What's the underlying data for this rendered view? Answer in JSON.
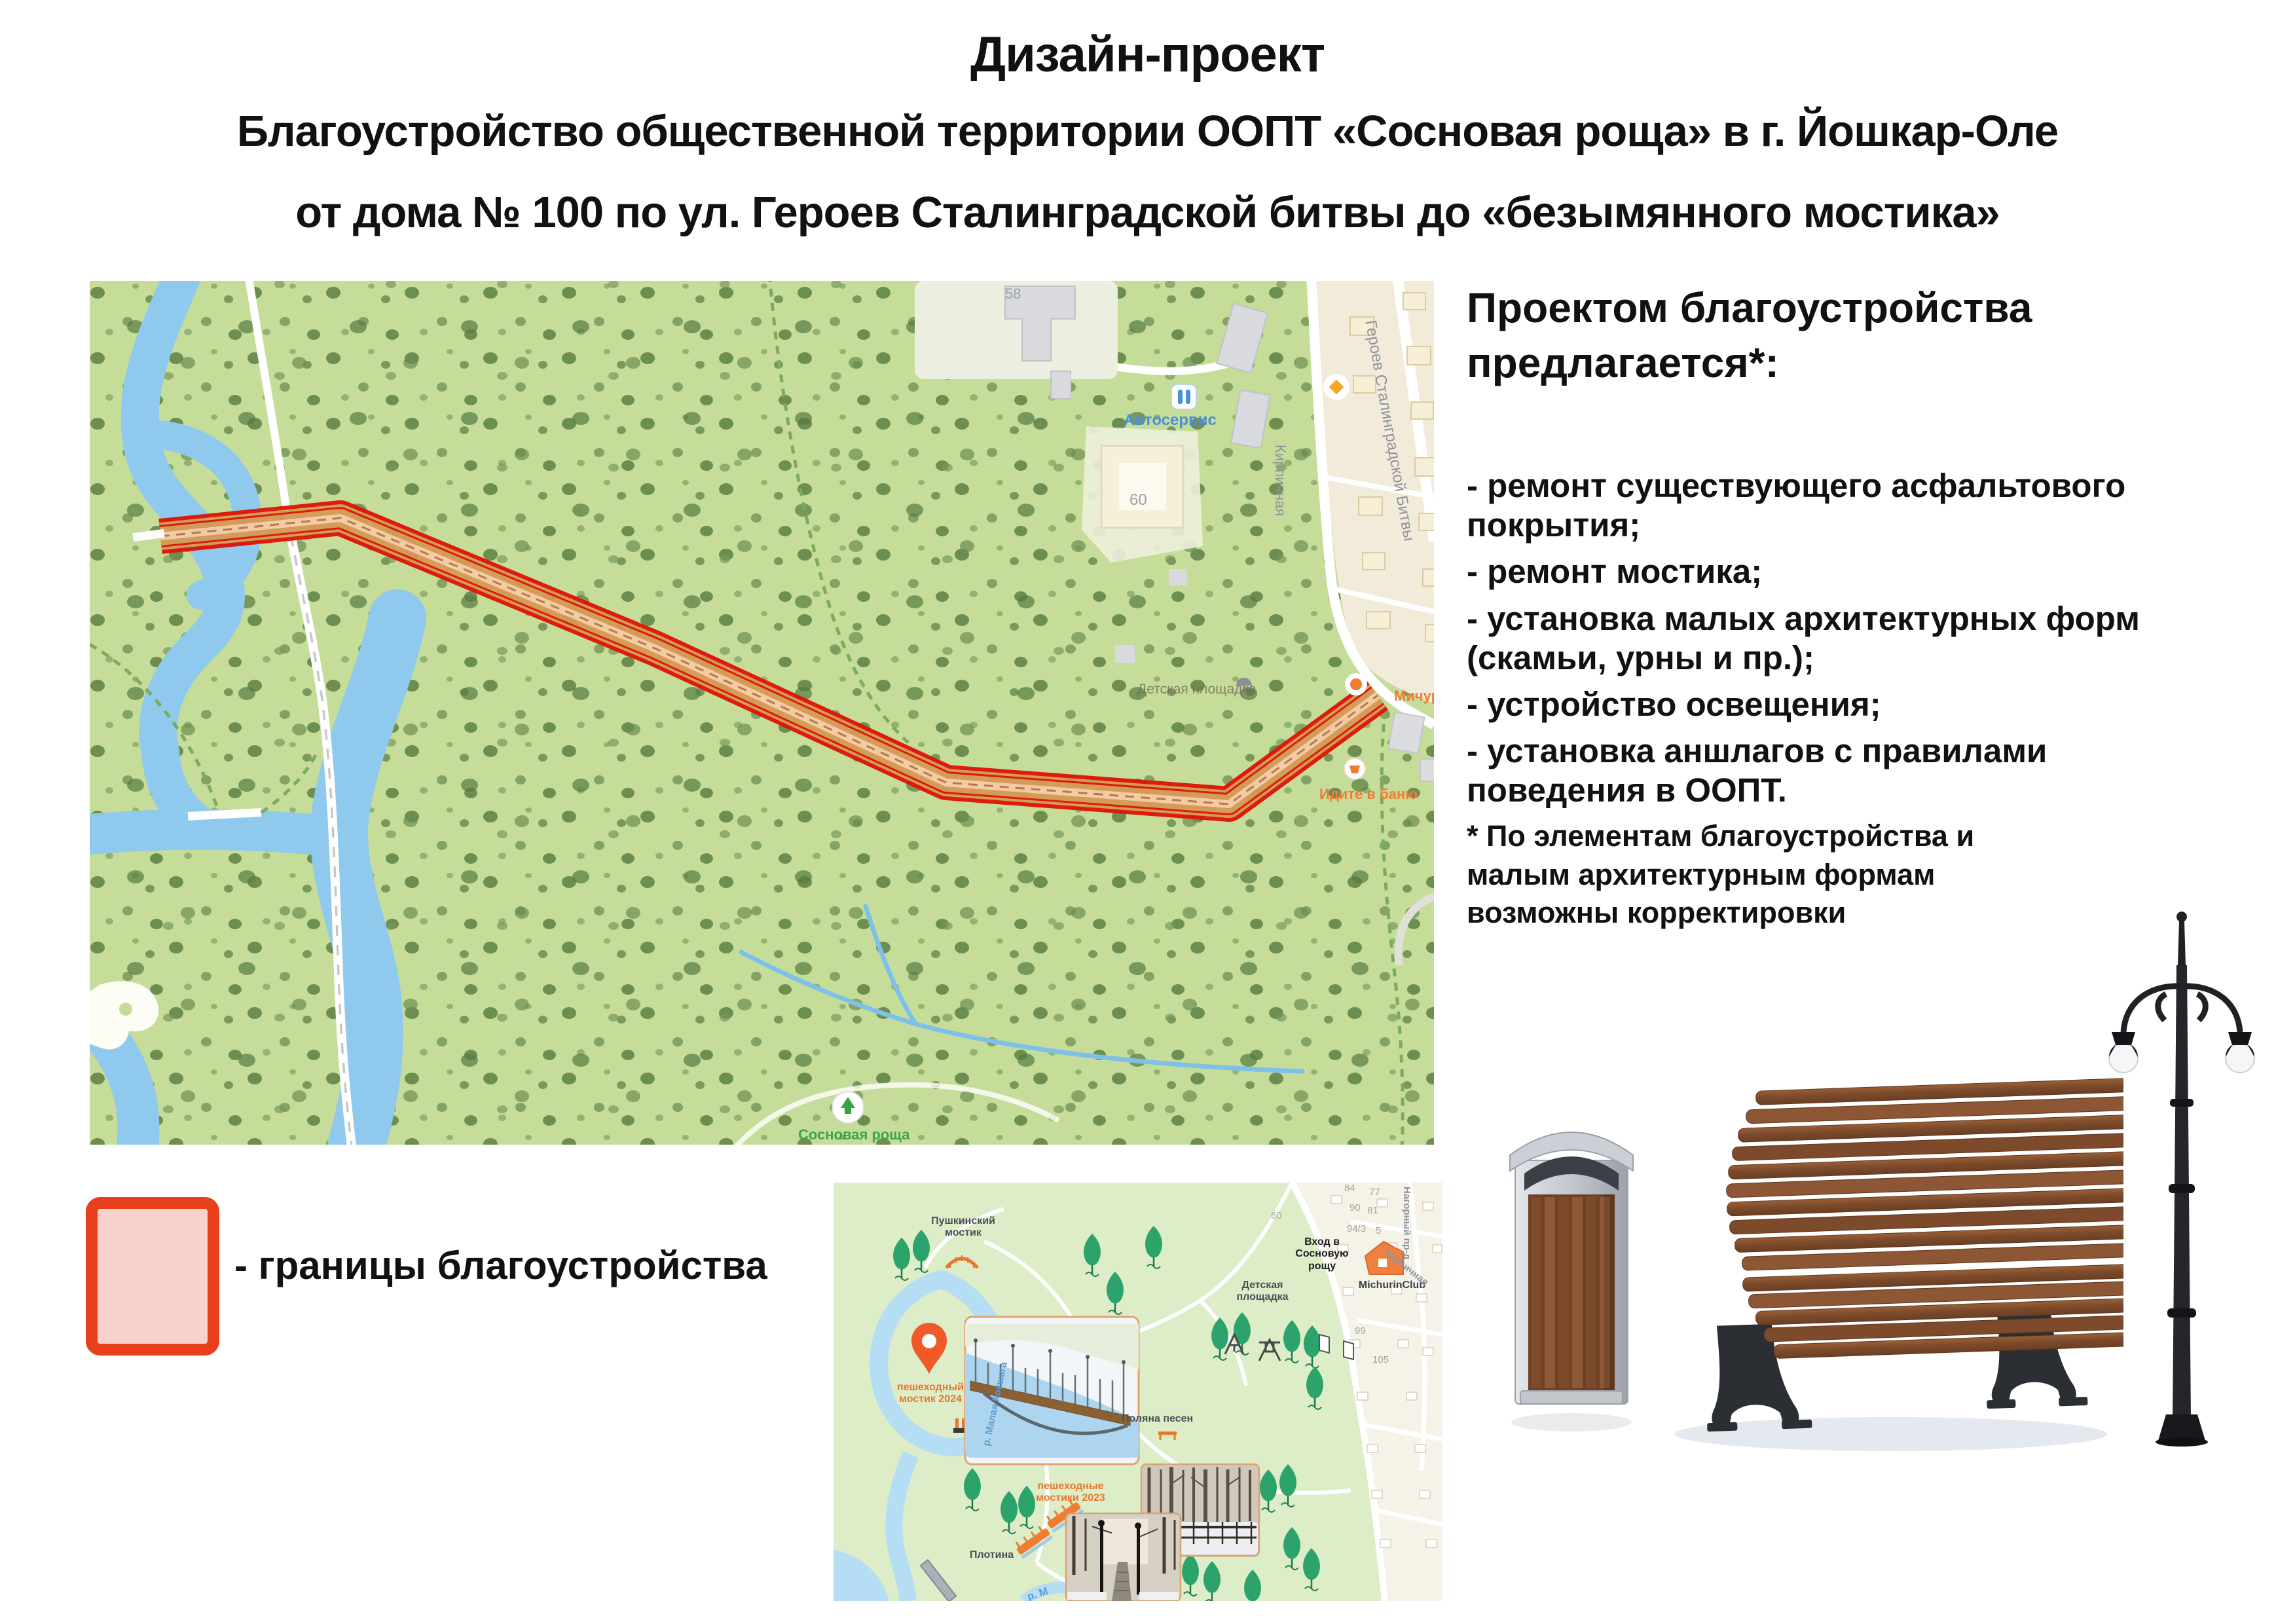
{
  "header": {
    "line1": "Дизайн-проект",
    "line2": "Благоустройство общественной территории ООПТ «Сосновая роща» в г. Йошкар-Оле",
    "line3": "от дома № 100 по ул. Героев Сталинградской битвы до «безымянного мостика»"
  },
  "proposals": {
    "heading": "Проектом благоустройства предлагается*:",
    "items": [
      "- ремонт существующего асфальтового покрытия;",
      "- ремонт мостика;",
      "- установка малых архитектурных форм (скамьи, урны и пр.);",
      "- устройство освещения;",
      "- установка аншлагов с правилами поведения в ООПТ."
    ]
  },
  "footnote": "* По элементам благоустройства и малым архитектурным формам возможны корректировки",
  "legend": {
    "label": "- границы благоустройства"
  },
  "main_map": {
    "labels": {
      "n58": "58",
      "autoservice": "Автосервис",
      "n60": "60",
      "street_kirpichnaya": "Кирпичная",
      "street_geroev": "Героев Сталинградской Битвы",
      "playground": "Детская площадка",
      "michurin": "Мичури",
      "banya": "Идите в баню",
      "grove": "Сосновая роща"
    }
  },
  "mini_map": {
    "labels": {
      "pushkin": "Пушкинский мостик",
      "bridge_2024": "пешеходный мостик 2024",
      "polyana": "Поляна песен",
      "playground": "Детская площадка",
      "entrance": "Вход в Сосновую рощу",
      "michurin_club": "MichurinClub",
      "bridges_2023": "пешеходные мостики 2023",
      "dam": "Плотина",
      "river": "р. Малая Кокшага",
      "river2": "р. М",
      "street_nagorny": "Нагорный пр-д",
      "street_kirpichnaya": "Кирпичная"
    },
    "numbers": {
      "n60": "60",
      "n84": "84",
      "n77": "77",
      "n90": "90",
      "n81": "81",
      "n94_3": "94/3",
      "n5": "5",
      "n99": "99",
      "n105": "105"
    }
  },
  "icons": {
    "pin": "location-pin",
    "tree": "tree",
    "bridge": "bridge",
    "house": "house",
    "diamond": "poi-diamond",
    "swing": "swing",
    "bench": "bench",
    "bin": "trash-bin",
    "lamp": "street-lamp"
  },
  "colors": {
    "corridor_border": "#de1508",
    "corridor_fill": "#d49a55",
    "map_green": "#c5dd98",
    "mini_green": "#dcedc8",
    "water": "#8fc9ee",
    "orange_accent": "#ef7d33",
    "legend_border": "#e8401c",
    "legend_fill": "#f8d2ca"
  }
}
